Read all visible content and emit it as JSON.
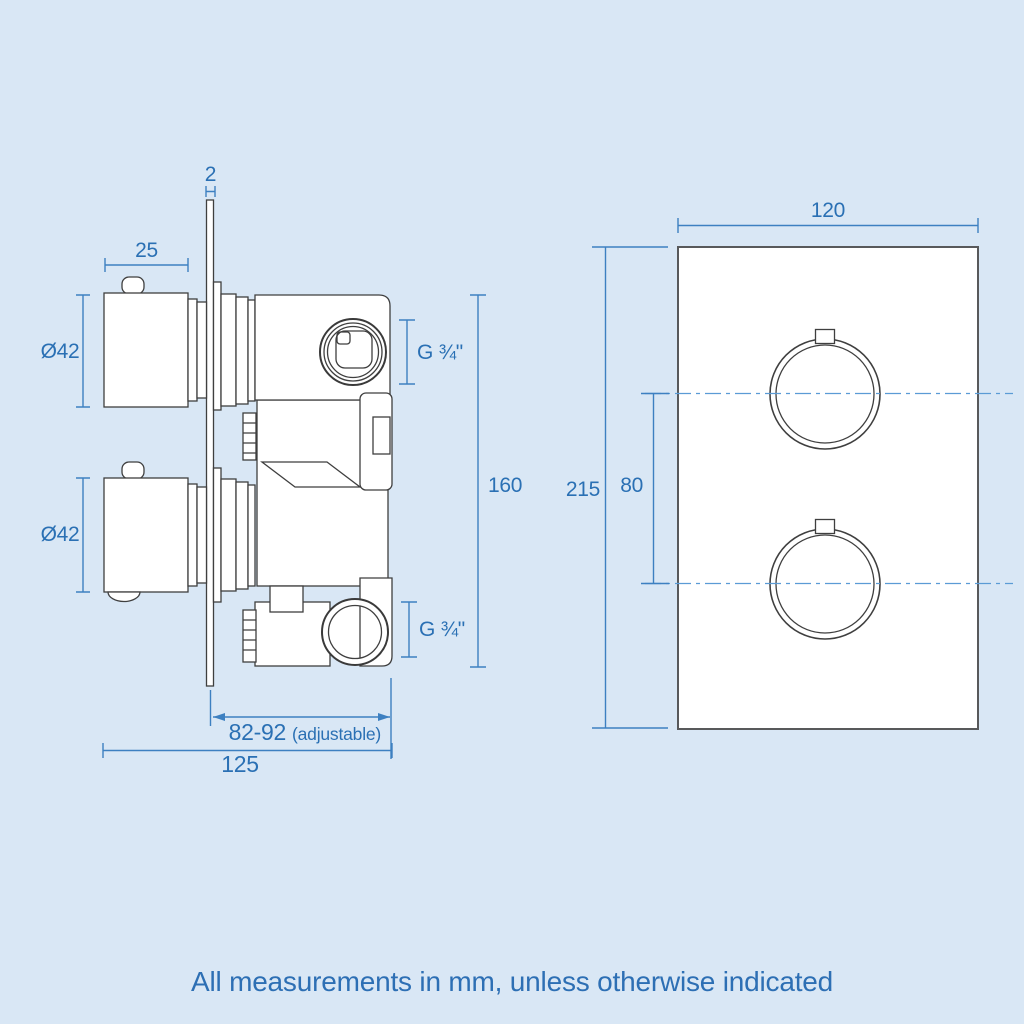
{
  "page": {
    "background_color": "#d9e7f5",
    "caption": "All measurements in mm, unless otherwise indicated"
  },
  "colors": {
    "dimension_line": "#3d80c1",
    "dimension_text": "#2a70b4",
    "centerline": "#5b9bd5",
    "drawing_line": "#3f3f3f",
    "shape_fill": "#ffffff"
  },
  "side_view": {
    "label": "valve-side-profile-view",
    "dims": {
      "plate_thickness": "2",
      "knob_depth": "25",
      "knob_diameter_top": "Ø42",
      "knob_diameter_bottom": "Ø42",
      "outlet_thread_top": "G ¾\"",
      "outlet_thread_bottom": "G ¾\"",
      "valve_height": "160",
      "recess_depth": "82-92",
      "recess_depth_note": "(adjustable)",
      "overall_depth": "125"
    }
  },
  "front_view": {
    "label": "valve-front-plate-view",
    "dims": {
      "plate_width": "120",
      "plate_height": "215",
      "handle_spacing": "80"
    }
  }
}
